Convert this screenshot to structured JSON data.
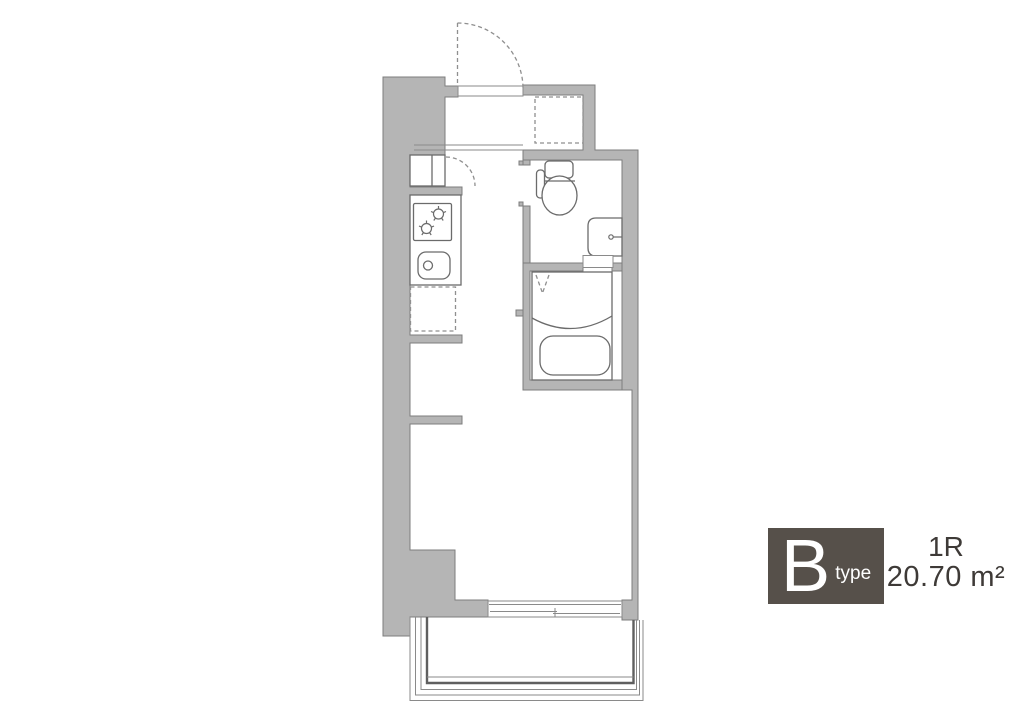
{
  "floor_plan": {
    "unit_label": {
      "letter": "B",
      "suffix": "type"
    },
    "layout_type": "1R",
    "area": "20.70 m²",
    "fixtures": [
      "entry-door",
      "entry-storage-space",
      "entry-step",
      "closet",
      "gas-stove-2-burner",
      "kitchen-sink",
      "refrigerator-space",
      "toilet",
      "washbasin",
      "unit-bath",
      "bathtub",
      "bath-folding-door",
      "sliding-window",
      "balcony"
    ]
  },
  "colors": {
    "wall_fill": "#b5b5b5",
    "wall_edge": "#7d7d7d",
    "fixture_line": "#6b6b6b",
    "dashed_line": "#8f8f8f",
    "thin_line": "#8a8a8a",
    "badge_bg": "#56504a",
    "badge_text": "#ffffff",
    "info_text": "#3e3a37",
    "background": "#ffffff"
  }
}
